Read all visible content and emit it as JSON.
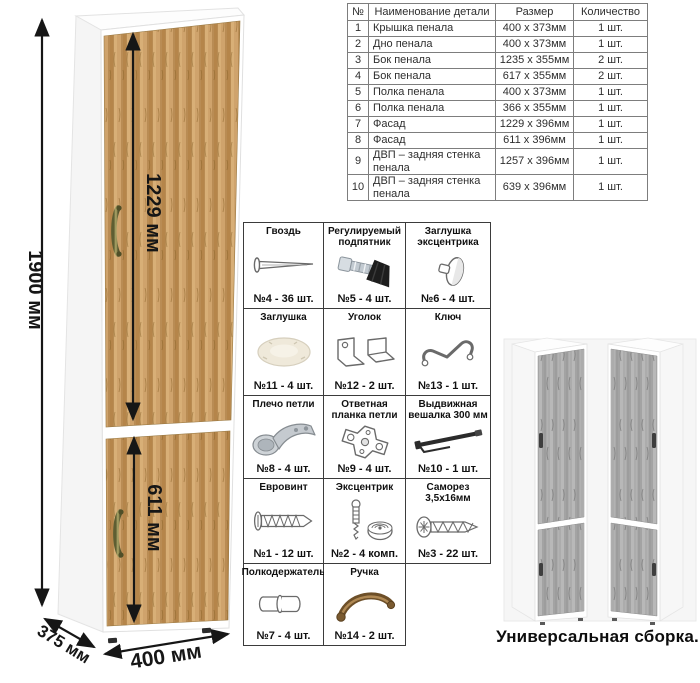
{
  "parts_table": {
    "headers": [
      "№",
      "Наименование детали",
      "Размер",
      "Количество"
    ],
    "rows": [
      [
        "1",
        "Крышка пенала",
        "400 х 373мм",
        "1 шт."
      ],
      [
        "2",
        "Дно пенала",
        "400 х 373мм",
        "1 шт."
      ],
      [
        "3",
        "Бок пенала",
        "1235 х 355мм",
        "2 шт."
      ],
      [
        "4",
        "Бок пенала",
        "617 х 355мм",
        "2 шт."
      ],
      [
        "5",
        "Полка пенала",
        "400 х 373мм",
        "1 шт."
      ],
      [
        "6",
        "Полка пенала",
        "366 х 355мм",
        "1 шт."
      ],
      [
        "7",
        "Фасад",
        "1229 х 396мм",
        "1 шт."
      ],
      [
        "8",
        "Фасад",
        "611 х 396мм",
        "1 шт."
      ],
      [
        "9",
        "ДВП – задняя стенка пенала",
        "1257 х 396мм",
        "1 шт."
      ],
      [
        "10",
        "ДВП – задняя стенка пенала",
        "639 х 396мм",
        "1 шт."
      ]
    ]
  },
  "dimensions": {
    "height_label": "1900 мм",
    "upper_door_label": "1229 мм",
    "lower_door_label": "611 мм",
    "depth_label": "375 мм",
    "width_label": "400 мм"
  },
  "hardware": {
    "items": [
      {
        "title": "Гвоздь",
        "icon": "nail-icon",
        "count": "№4 - 36 шт."
      },
      {
        "title": "Регулируемый подпятник",
        "icon": "adjustable-foot-icon",
        "count": "№5 - 4 шт."
      },
      {
        "title": "Заглушка эксцентрика",
        "icon": "cam-cap-icon",
        "count": "№6 - 4 шт."
      },
      {
        "title": "Заглушка",
        "icon": "cover-cap-icon",
        "count": "№11 - 4 шт."
      },
      {
        "title": "Уголок",
        "icon": "corner-bracket-icon",
        "count": "№12 - 2 шт."
      },
      {
        "title": "Ключ",
        "icon": "hex-key-icon",
        "count": "№13 - 1 шт."
      },
      {
        "title": "Плечо петли",
        "icon": "hinge-arm-icon",
        "count": "№8 - 4 шт."
      },
      {
        "title": "Ответная планка петли",
        "icon": "hinge-plate-icon",
        "count": "№9 - 4 шт."
      },
      {
        "title": "Выдвижная вешалка 300 мм",
        "icon": "pullout-hanger-icon",
        "count": "№10 - 1 шт."
      },
      {
        "title": "Евровинт",
        "icon": "euro-screw-icon",
        "count": "№1 - 12 шт."
      },
      {
        "title": "Эксцентрик",
        "icon": "cam-lock-icon",
        "count": "№2 - 4 комп."
      },
      {
        "title": "Саморез 3,5х16мм",
        "icon": "self-tapping-screw-icon",
        "count": "№3 - 22 шт."
      },
      {
        "title": "Полкодержатель",
        "icon": "shelf-pin-icon",
        "count": "№7 - 4 шт."
      },
      {
        "title": "Ручка",
        "icon": "handle-icon",
        "count": "№14 - 2 шт."
      }
    ]
  },
  "caption": "Универсальная сборка.",
  "colors": {
    "wood": "#c2925c",
    "gray_wood": "#ababab",
    "handle_bronze": "#7a6a38",
    "dimension_line": "#161616",
    "table_border": "#7d7d7d",
    "grid_border": "#3b3b3b"
  }
}
